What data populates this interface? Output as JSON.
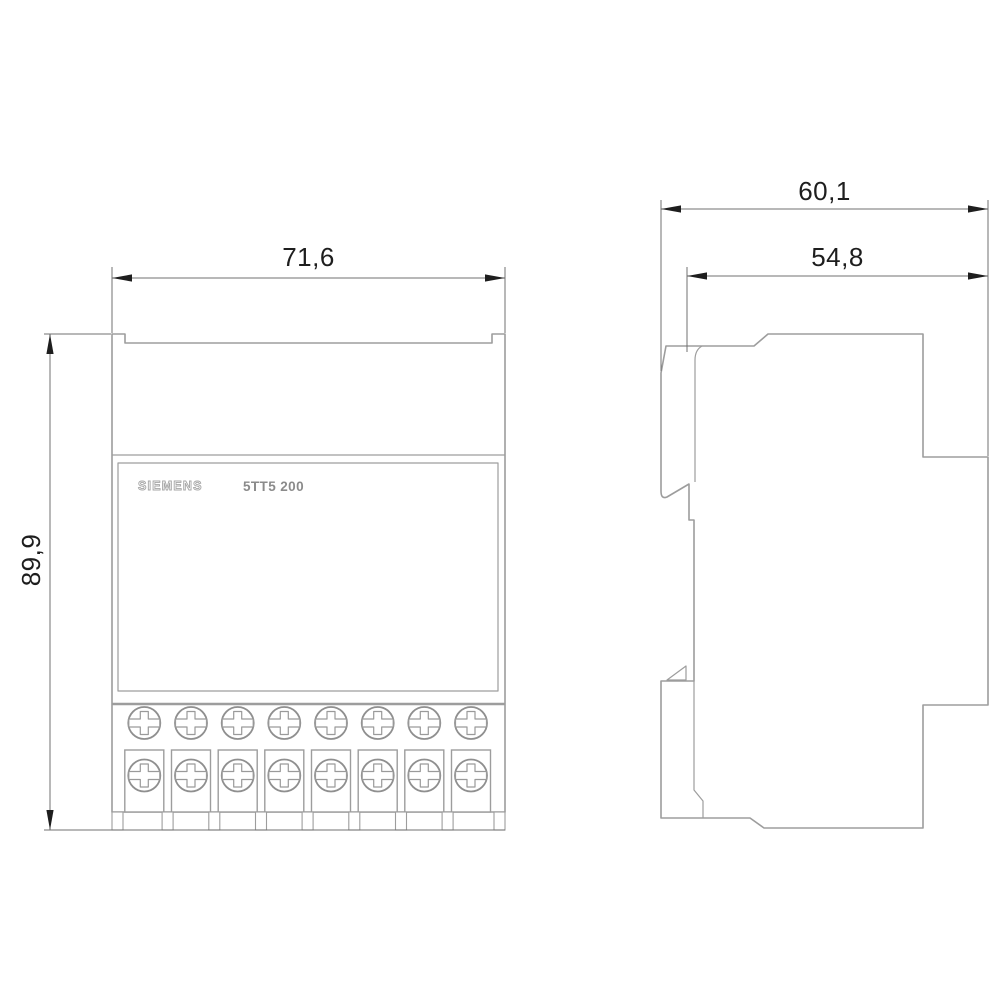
{
  "drawing": {
    "front_view": {
      "brand_label": "SIEMENS",
      "model_label": "5TT5 200",
      "width_dim": "71,6",
      "height_dim": "89,9"
    },
    "side_view": {
      "overall_depth_dim": "60,1",
      "body_depth_dim": "54,8"
    },
    "colors": {
      "background": "#ffffff",
      "device_outline": "#9d9d9d",
      "dimension_line": "#707070",
      "dimension_text": "#1e1e1e",
      "brand_text": "#a6a6a6",
      "model_text": "#8b8b8b"
    }
  }
}
